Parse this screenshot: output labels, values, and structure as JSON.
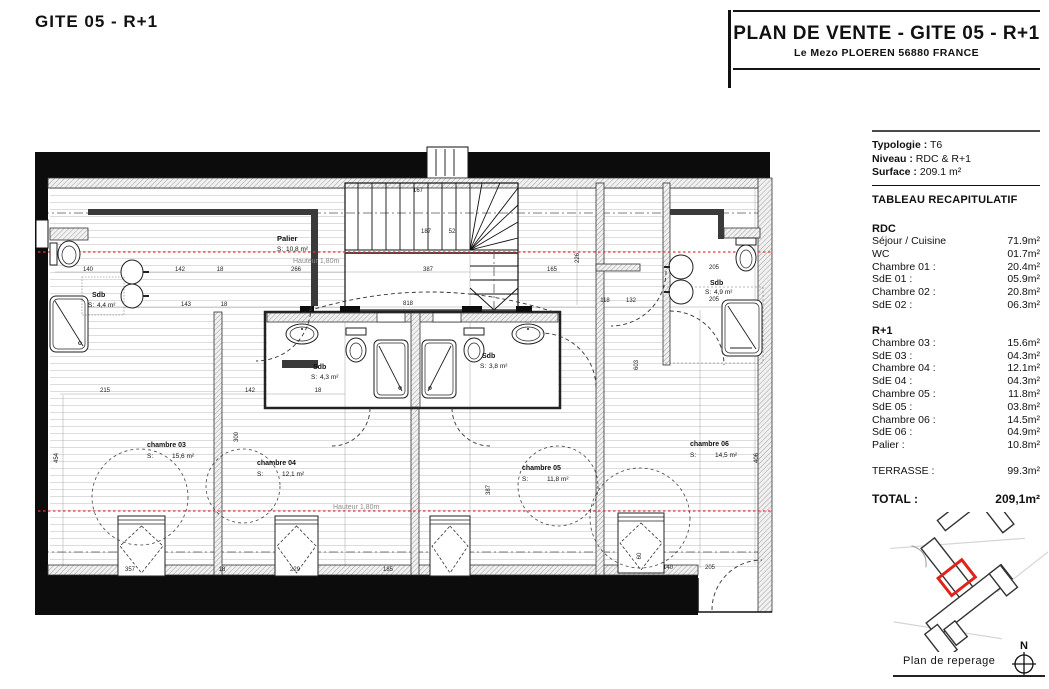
{
  "page_title": "GITE 05 - R+1",
  "header": {
    "title": "PLAN DE VENTE - GITE 05 - R+1",
    "subtitle": "Le Mezo PLOEREN 56880 FRANCE"
  },
  "summary": {
    "typologie_label": "Typologie :",
    "typologie_value": "T6",
    "niveau_label": "Niveau :",
    "niveau_value": "RDC & R+1",
    "surface_label": "Surface :",
    "surface_value": "209.1 m²",
    "table_title": "TABLEAU RECAPITULATIF",
    "sections": [
      {
        "title": "RDC",
        "rows": [
          {
            "label": "Séjour / Cuisine",
            "value": "71.9m²"
          },
          {
            "label": "WC",
            "value": "01.7m²"
          },
          {
            "label": "Chambre 01 :",
            "value": "20.4m²"
          },
          {
            "label": "SdE 01 :",
            "value": "05.9m²"
          },
          {
            "label": "Chambre 02 :",
            "value": "20.8m²"
          },
          {
            "label": "SdE 02 :",
            "value": "06.3m²"
          }
        ]
      },
      {
        "title": "R+1",
        "rows": [
          {
            "label": "Chambre 03 :",
            "value": "15.6m²"
          },
          {
            "label": "SdE 03 :",
            "value": "04.3m²"
          },
          {
            "label": "Chambre 04 :",
            "value": "12.1m²"
          },
          {
            "label": "SdE 04 :",
            "value": "04.3m²"
          },
          {
            "label": "Chambre 05 :",
            "value": "11.8m²"
          },
          {
            "label": "SdE 05 :",
            "value": "03.8m²"
          },
          {
            "label": "Chambre 06 :",
            "value": "14.5m²"
          },
          {
            "label": "SdE 06 :",
            "value": "04.9m²"
          },
          {
            "label": "Palier :",
            "value": "10.8m²"
          }
        ]
      }
    ],
    "terrasse": {
      "label": "TERRASSE :",
      "value": "99.3m²"
    },
    "total": {
      "label": "TOTAL :",
      "value": "209,1m²"
    }
  },
  "plan": {
    "rooms": [
      {
        "name": "Palier",
        "s": "S:",
        "area": "10,8 m²"
      },
      {
        "name": "Sdb",
        "s": "S:",
        "area": "4,4 m²"
      },
      {
        "name": "Sdb",
        "s": "S:",
        "area": "4,3 m²"
      },
      {
        "name": "Sdb",
        "s": "S:",
        "area": "3,8 m²"
      },
      {
        "name": "Sdb",
        "s": "S:",
        "area": "4,9 m²"
      },
      {
        "name": "chambre 03",
        "s": "S:",
        "area": "15,6 m²"
      },
      {
        "name": "chambre 04",
        "s": "S:",
        "area": "12,1 m²"
      },
      {
        "name": "chambre 05",
        "s": "S:",
        "area": "11,8 m²"
      },
      {
        "name": "chambre 06",
        "s": "S:",
        "area": "14,5 m²"
      }
    ],
    "annotations": {
      "hauteur1": "Hauteur 1,80m",
      "hauteur2": "Hauteur 1,80m"
    },
    "dims": [
      "140",
      "142",
      "18",
      "143",
      "18",
      "266",
      "387",
      "165",
      "818",
      "187",
      "52",
      "167",
      "118",
      "132",
      "205",
      "205",
      "215",
      "142",
      "18",
      "357",
      "18",
      "229",
      "185",
      "140",
      "205",
      "226",
      "300",
      "387",
      "454",
      "406",
      "603",
      "60"
    ]
  },
  "reperage": {
    "label": "Plan de reperage",
    "north_label": "N"
  },
  "colors": {
    "accent_red": "#e53935",
    "highlight_red": "#e0241b",
    "ink": "#111111"
  }
}
